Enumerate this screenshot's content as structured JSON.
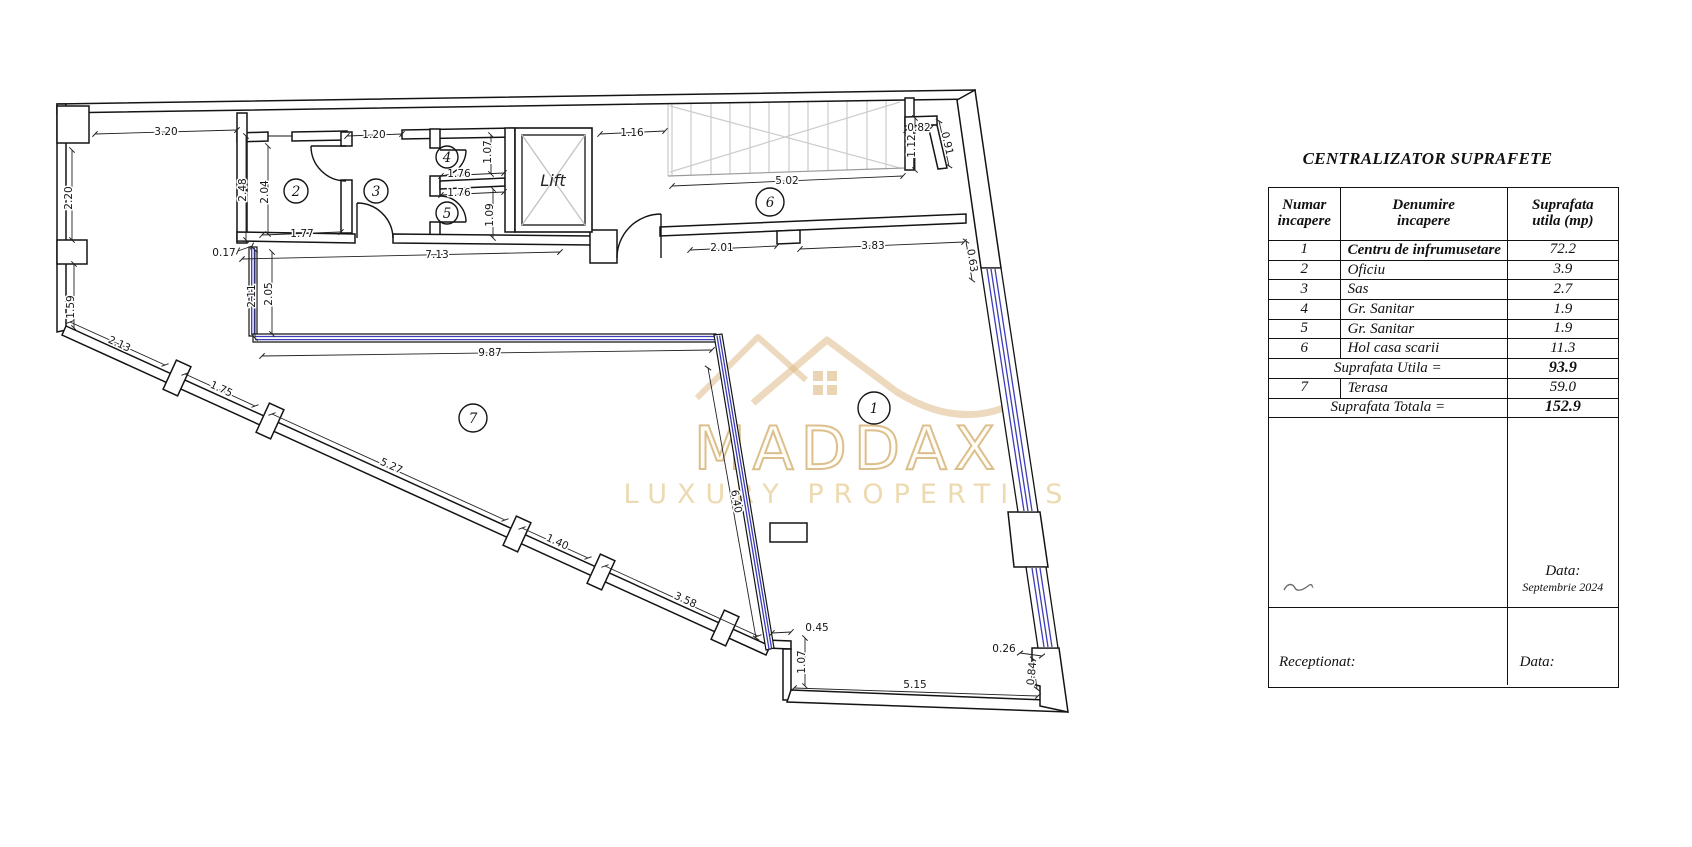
{
  "plan": {
    "lift_label": "Lift",
    "watermark": {
      "line1": "MADDAX",
      "line2": "LUXURY PROPERTIES",
      "color": "#ddbf8d"
    },
    "window_color": "#3d3db8",
    "rooms": {
      "r1": "1",
      "r2": "2",
      "r3": "3",
      "r4": "4",
      "r5": "5",
      "r6": "6",
      "r7": "7"
    },
    "dims": {
      "d320": "3.20",
      "d120": "1.20",
      "d116": "1.16",
      "d082": "0.82",
      "d502": "5.02",
      "d176a": "1.76",
      "d176b": "1.76",
      "d177": "1.77",
      "d017": "0.17",
      "d713": "7.13",
      "d201": "2.01",
      "d383": "3.83",
      "d987": "9.87",
      "d045": "0.45",
      "d026": "0.26",
      "d515": "5.15",
      "d220": "2.20",
      "d159": "1.59",
      "d248": "2.48",
      "d204": "2.04",
      "d107a": "1.07",
      "d109": "1.09",
      "d211": "2.11",
      "d205": "2.05",
      "d112": "1.12",
      "d107b": "1.07",
      "d084": "0.84",
      "d091": "0.91",
      "d063": "0.63",
      "d213": "2.13",
      "d175": "1.75",
      "d527": "5.27",
      "d140": "1.40",
      "d358": "3.58",
      "d640": "6.40"
    }
  },
  "table": {
    "title": "CENTRALIZATOR SUPRAFETE",
    "headers": [
      {
        "l1": "Numar",
        "l2": "incapere"
      },
      {
        "l1": "Denumire",
        "l2": "incapere"
      },
      {
        "l1": "Suprafata",
        "l2": "utila (mp)"
      }
    ],
    "rows": [
      {
        "nr": "1",
        "name": "Centru de infrumusetare",
        "value": "72.2"
      },
      {
        "nr": "2",
        "name": "Oficiu",
        "value": "3.9"
      },
      {
        "nr": "3",
        "name": "Sas",
        "value": "2.7"
      },
      {
        "nr": "4",
        "name": "Gr. Sanitar",
        "value": "1.9"
      },
      {
        "nr": "5",
        "name": "Gr. Sanitar",
        "value": "1.9"
      },
      {
        "nr": "6",
        "name": "Hol casa scarii",
        "value": "11.3"
      }
    ],
    "subtotal": {
      "label": "Suprafata Utila  =",
      "value": "93.9"
    },
    "row7": {
      "nr": "7",
      "name": "Terasa",
      "value": "59.0"
    },
    "total": {
      "label": "Suprafata Totala  =",
      "value": "152.9"
    },
    "date_label": "Data:",
    "date_value": "Septembrie 2024",
    "receptionat_label": "Receptionat:",
    "bottom_date_label": "Data:"
  }
}
